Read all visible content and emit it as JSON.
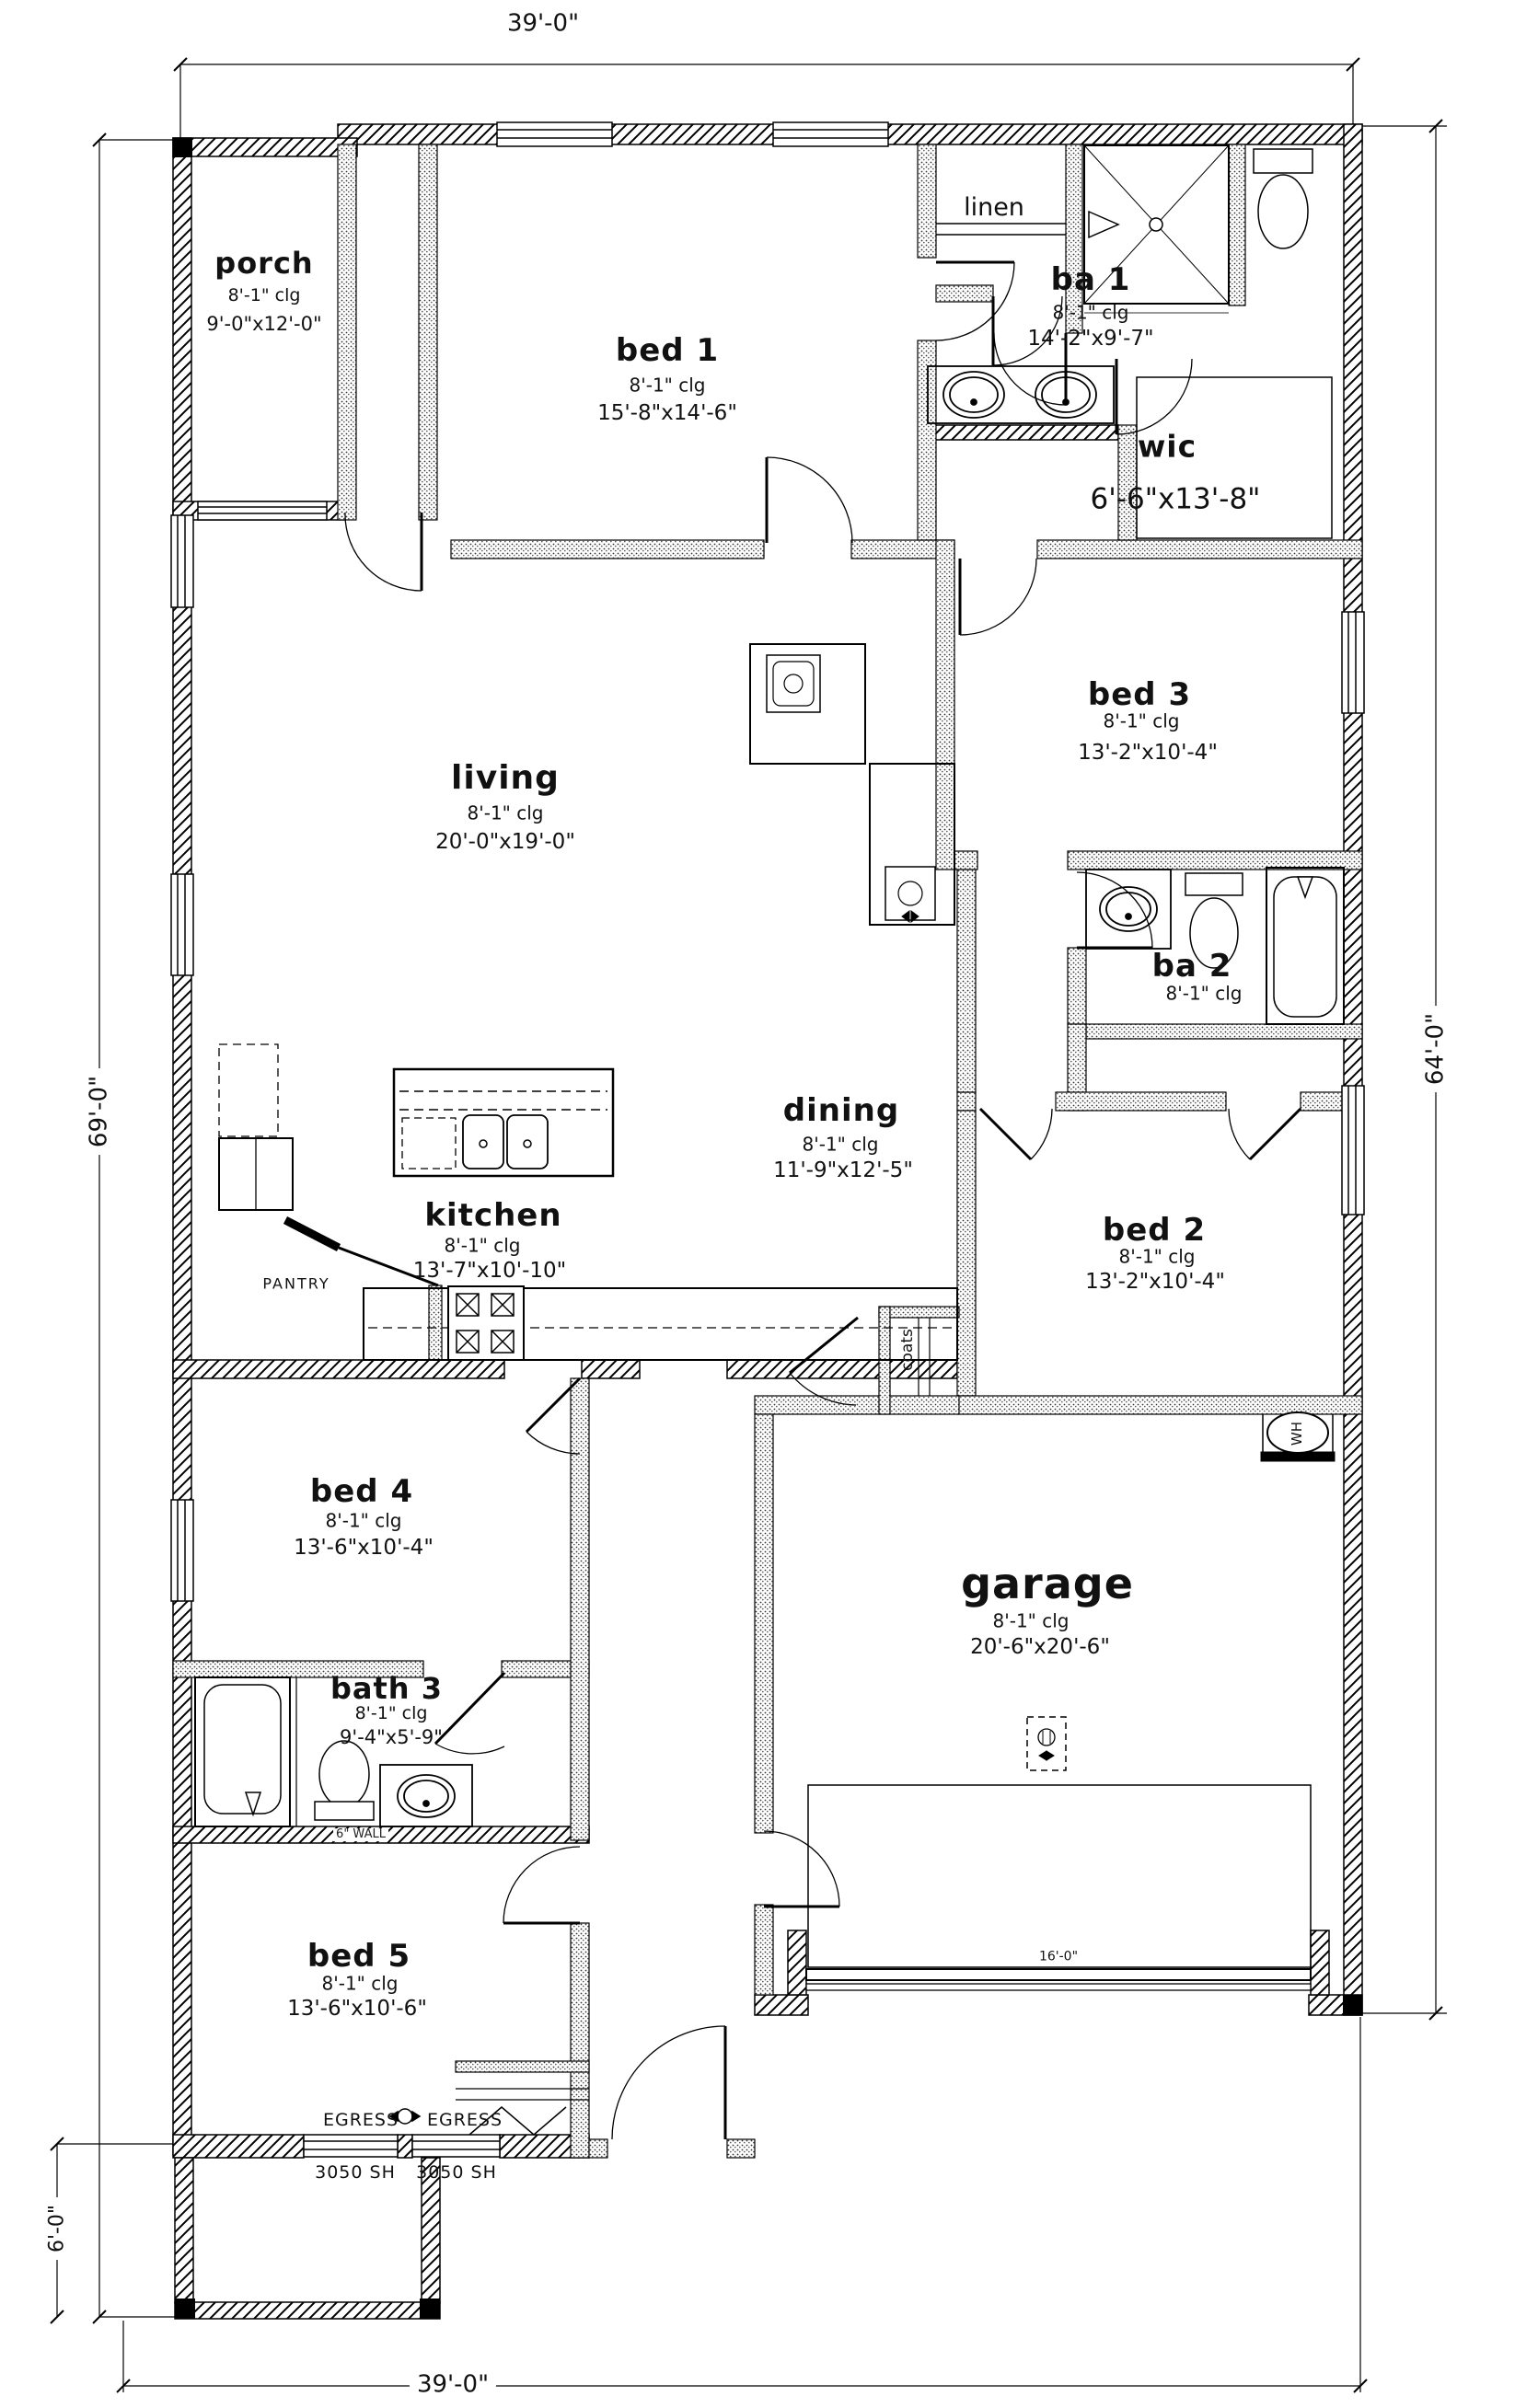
{
  "drawing": {
    "dim_width_top": "39'-0\"",
    "dim_width_bottom": "39'-0\"",
    "dim_height_right": "64'-0\"",
    "dim_height_left": "69'-0\"",
    "dim_porch_depth": "6'-0\"",
    "garage_door_width": "16'-0\""
  },
  "rooms": {
    "porch": {
      "name": "porch",
      "clg": "8'-1\" clg",
      "size": "9'-0\"x12'-0\""
    },
    "bed1": {
      "name": "bed 1",
      "clg": "8'-1\" clg",
      "size": "15'-8\"x14'-6\""
    },
    "linen": {
      "name": "linen"
    },
    "ba1": {
      "name": "ba 1",
      "clg": "8'-1\" clg",
      "size": "14'-2\"x9'-7\""
    },
    "wic": {
      "name": "wic",
      "size": "6'-6\"x13'-8\""
    },
    "bed3": {
      "name": "bed 3",
      "clg": "8'-1\" clg",
      "size": "13'-2\"x10'-4\""
    },
    "living": {
      "name": "living",
      "clg": "8'-1\" clg",
      "size": "20'-0\"x19'-0\""
    },
    "ba2": {
      "name": "ba 2",
      "clg": "8'-1\" clg"
    },
    "dining": {
      "name": "dining",
      "clg": "8'-1\" clg",
      "size": "11'-9\"x12'-5\""
    },
    "bed2": {
      "name": "bed 2",
      "clg": "8'-1\" clg",
      "size": "13'-2\"x10'-4\""
    },
    "kitchen": {
      "name": "kitchen",
      "clg": "8'-1\" clg",
      "size": "13'-7\"x10'-10\""
    },
    "pantry": {
      "name": "PANTRY"
    },
    "coats": {
      "name": "coats"
    },
    "garage": {
      "name": "garage",
      "clg": "8'-1\" clg",
      "size": "20'-6\"x20'-6\""
    },
    "bed4": {
      "name": "bed 4",
      "clg": "8'-1\" clg",
      "size": "13'-6\"x10'-4\""
    },
    "bath3": {
      "name": "bath 3",
      "clg": "8'-1\" clg",
      "size": "9'-4\"x5'-9\""
    },
    "bed5": {
      "name": "bed 5",
      "clg": "8'-1\" clg",
      "size": "13'-6\"x10'-6\""
    }
  },
  "annotations": {
    "wh": "WH",
    "wall_note": "6\" WALL",
    "egress": "EGRESS",
    "window_size": "3050 SH"
  }
}
